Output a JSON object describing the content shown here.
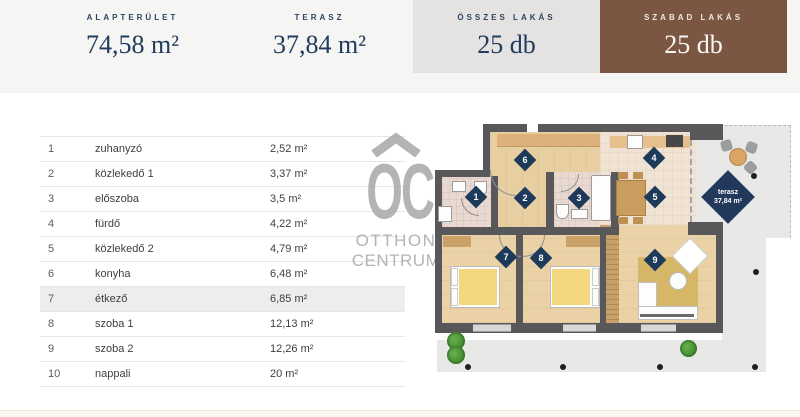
{
  "header": {
    "cards": [
      {
        "label": "ALAPTERÜLET",
        "value": "74,58 m²"
      },
      {
        "label": "TERASZ",
        "value": "37,84 m²"
      },
      {
        "label": "ÖSSZES LAKÁS",
        "value": "25 db"
      },
      {
        "label": "SZABAD LAKÁS",
        "value": "25 db"
      }
    ],
    "colors": {
      "strip_bg": "#f5f5f3",
      "gray_card_bg": "#e4e3e1",
      "brown_card_bg": "#7b5743",
      "navy_text": "#223c5e"
    }
  },
  "rooms_table": {
    "rows": [
      {
        "num": "1",
        "name": "zuhanyzó",
        "area": "2,52 m²",
        "highlighted": false
      },
      {
        "num": "2",
        "name": "közlekedő 1",
        "area": "3,37 m²",
        "highlighted": false
      },
      {
        "num": "3",
        "name": "előszoba",
        "area": "3,5 m²",
        "highlighted": false
      },
      {
        "num": "4",
        "name": "fürdő",
        "area": "4,22 m²",
        "highlighted": false
      },
      {
        "num": "5",
        "name": "közlekedő 2",
        "area": "4,79 m²",
        "highlighted": false
      },
      {
        "num": "6",
        "name": "konyha",
        "area": "6,48 m²",
        "highlighted": false
      },
      {
        "num": "7",
        "name": "étkező",
        "area": "6,85 m²",
        "highlighted": true
      },
      {
        "num": "8",
        "name": "szoba 1",
        "area": "12,13 m²",
        "highlighted": false
      },
      {
        "num": "9",
        "name": "szoba 2",
        "area": "12,26 m²",
        "highlighted": false
      },
      {
        "num": "10",
        "name": "nappali",
        "area": "20 m²",
        "highlighted": false
      }
    ]
  },
  "watermark": {
    "monogram": "OC",
    "line1": "OTTHON",
    "line2": "CENTRUM"
  },
  "floor_plan": {
    "markers": [
      {
        "n": "1",
        "x": 43,
        "y": 87
      },
      {
        "n": "2",
        "x": 92,
        "y": 88
      },
      {
        "n": "3",
        "x": 146,
        "y": 88
      },
      {
        "n": "4",
        "x": 221,
        "y": 48
      },
      {
        "n": "5",
        "x": 222,
        "y": 87
      },
      {
        "n": "6",
        "x": 92,
        "y": 50
      },
      {
        "n": "7",
        "x": 73,
        "y": 147
      },
      {
        "n": "8",
        "x": 108,
        "y": 148
      },
      {
        "n": "9",
        "x": 222,
        "y": 150
      }
    ],
    "terrace_label": {
      "title": "terasz",
      "area": "37,84 m²"
    },
    "colors": {
      "wall": "#58585a",
      "wood": "#e7cfa2",
      "tile": "#ead9d0",
      "terrace": "#e8e8e6",
      "bed": "#f3d67d",
      "rug": "#d6b667",
      "marker": "#1e3a5b"
    }
  }
}
